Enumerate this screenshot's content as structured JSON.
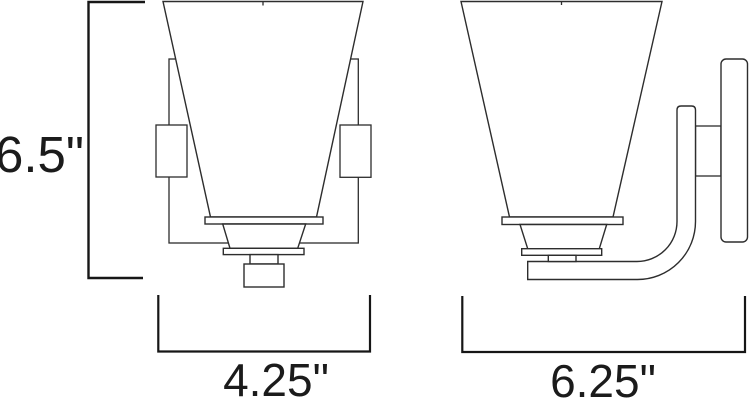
{
  "diagram": {
    "colors": {
      "background": "#ffffff",
      "line_color": "#2d2d2d",
      "dimension_color": "#161616",
      "text_color": "#1b1b1b"
    },
    "dimensions": {
      "height": "6.5\"",
      "front_width": "4.25\"",
      "side_width": "6.25\""
    }
  }
}
